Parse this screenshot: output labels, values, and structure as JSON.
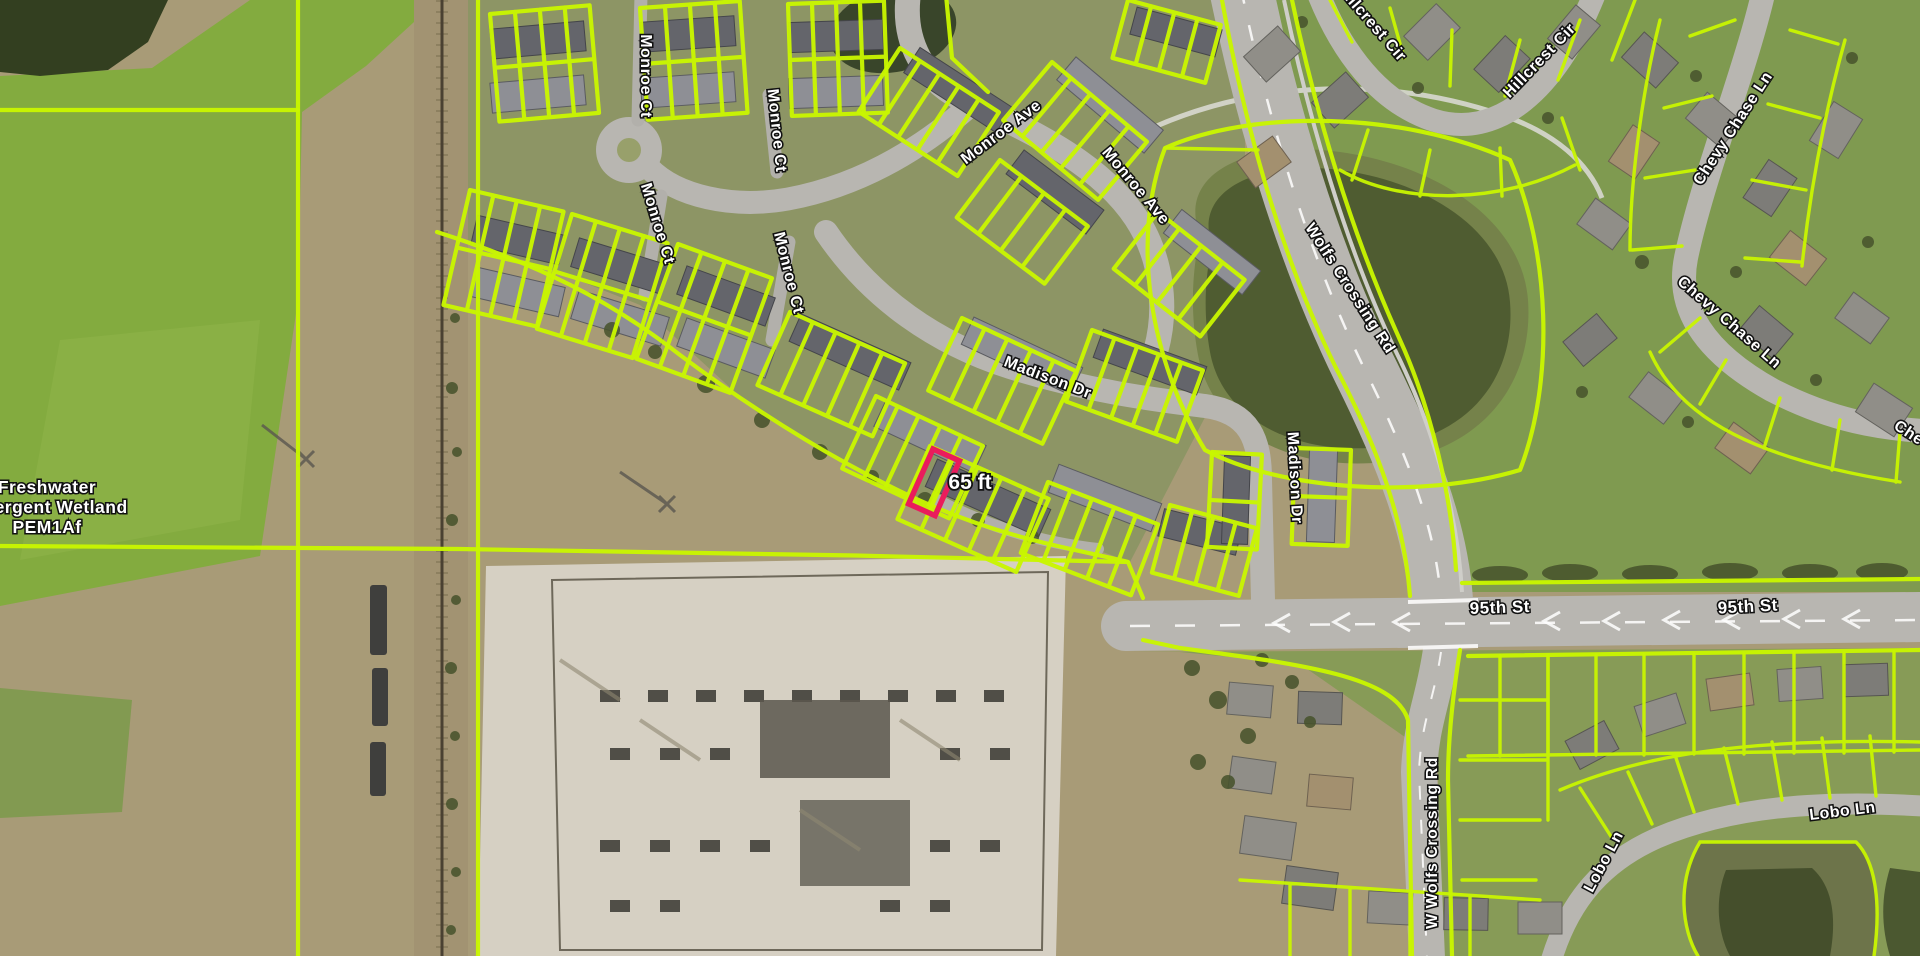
{
  "map": {
    "description": "Aerial parcel map with lot boundaries and road labels",
    "colors": {
      "parcel_line": "#c9f600",
      "highlight": "#ea1c5c",
      "label_fill": "#ffffff",
      "label_outline": "#111111"
    },
    "road_labels": [
      {
        "id": "monroe-ct-a",
        "text": "Monroe Ct",
        "x": 641,
        "y": 76,
        "rot": 90,
        "size": 16
      },
      {
        "id": "monroe-ct-b",
        "text": "Monroe Ct",
        "x": 772,
        "y": 131,
        "rot": 84,
        "size": 16
      },
      {
        "id": "monroe-ct-c",
        "text": "Monroe Ct",
        "x": 653,
        "y": 225,
        "rot": 73,
        "size": 16
      },
      {
        "id": "monroe-ct-d",
        "text": "Monroe Ct",
        "x": 784,
        "y": 274,
        "rot": 76,
        "size": 16
      },
      {
        "id": "monroe-ave-a",
        "text": "Monroe Ave",
        "x": 1004,
        "y": 136,
        "rot": -37,
        "size": 16
      },
      {
        "id": "monroe-ave-b",
        "text": "Monroe Ave",
        "x": 1132,
        "y": 189,
        "rot": 50,
        "size": 16
      },
      {
        "id": "wolfs-crossing-rd",
        "text": "Wolfs Crossing Rd",
        "x": 1346,
        "y": 291,
        "rot": 57,
        "size": 16
      },
      {
        "id": "madison-dr-a",
        "text": "Madison Dr",
        "x": 1046,
        "y": 382,
        "rot": 21,
        "size": 16
      },
      {
        "id": "madison-dr-b",
        "text": "Madison Dr",
        "x": 1290,
        "y": 478,
        "rot": 87,
        "size": 16
      },
      {
        "id": "hillcrest-cir-a",
        "text": "Hillcrest Cir",
        "x": 1368,
        "y": 26,
        "rot": 49,
        "size": 16
      },
      {
        "id": "hillcrest-cir-b",
        "text": "Hillcrest Cir",
        "x": 1543,
        "y": 64,
        "rot": -46,
        "size": 16
      },
      {
        "id": "chevy-chase-ln-a",
        "text": "Chevy Chase Ln",
        "x": 1737,
        "y": 131,
        "rot": -57,
        "size": 16
      },
      {
        "id": "chevy-chase-ln-b",
        "text": "Chevy Chase Ln",
        "x": 1726,
        "y": 326,
        "rot": 41,
        "size": 16
      },
      {
        "id": "chevy-chase-ln-c",
        "text": "Chevy Chase Ln",
        "x": 1948,
        "y": 464,
        "rot": 33,
        "size": 16
      },
      {
        "id": "ninety-fifth-st-a",
        "text": "95th St",
        "x": 1500,
        "y": 613,
        "rot": -2,
        "size": 17
      },
      {
        "id": "ninety-fifth-st-b",
        "text": "95th St",
        "x": 1748,
        "y": 612,
        "rot": -3,
        "size": 17
      },
      {
        "id": "lobo-ln-a",
        "text": "Lobo Ln",
        "x": 1608,
        "y": 864,
        "rot": -62,
        "size": 16
      },
      {
        "id": "lobo-ln-b",
        "text": "Lobo Ln",
        "x": 1843,
        "y": 816,
        "rot": -7,
        "size": 16
      },
      {
        "id": "w-wolfs-crossing-rd",
        "text": "W Wolfs Crossing Rd",
        "x": 1437,
        "y": 843,
        "rot": -90,
        "size": 16
      }
    ],
    "area_label": {
      "id": "wetland",
      "lines": [
        "Freshwater",
        "Emergent Wetland",
        "PEM1Af"
      ],
      "x": 47,
      "y": 493,
      "line_height": 20,
      "size": 17.5
    },
    "measurement": {
      "id": "highlight-measurement",
      "text": "65 ft",
      "x": 970,
      "y": 489,
      "rot": 0,
      "size": 21
    }
  }
}
